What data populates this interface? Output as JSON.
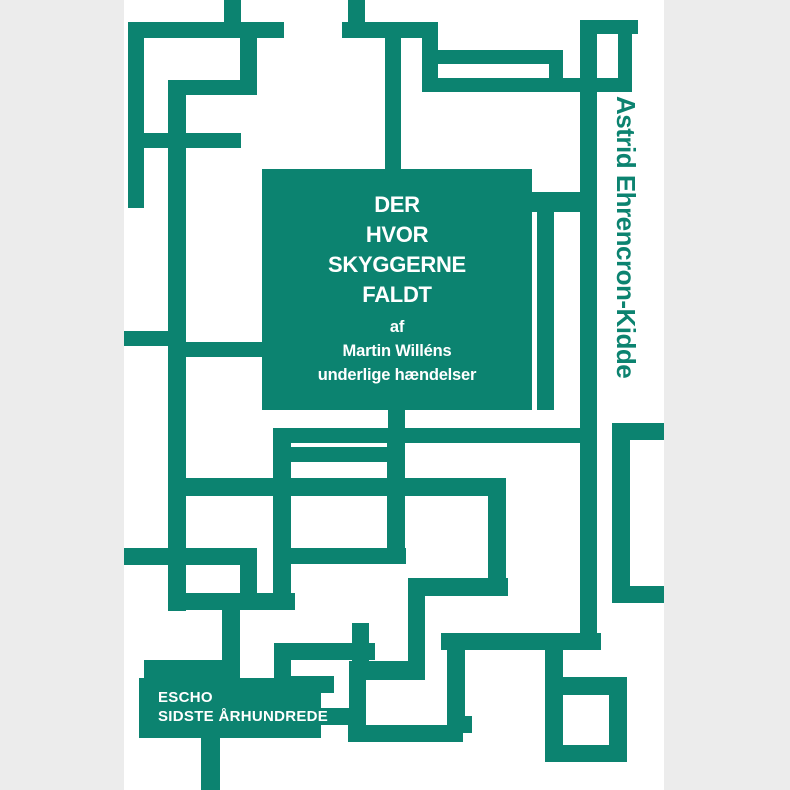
{
  "background": {
    "page_bg": "#ECECEC",
    "cover_bg": "#FFFFFF",
    "accent": "#0C8370",
    "text_on_accent": "#FFFFFF"
  },
  "cover": {
    "title_lines": [
      "DER",
      "HVOR",
      "SKYGGERNE",
      "FALDT"
    ],
    "subtitle_lines": [
      "af",
      "Martin Willéns",
      "underlige hændelser"
    ],
    "author": "Astrid Ehrencron-Kidde",
    "publisher_lines": [
      "ESCHO",
      "SIDSTE ÅRHUNDREDE"
    ]
  },
  "maze": {
    "segments": [
      [
        224,
        0,
        17,
        38
      ],
      [
        128,
        22,
        156,
        16
      ],
      [
        128,
        22,
        16,
        186
      ],
      [
        128,
        133,
        113,
        15
      ],
      [
        240,
        38,
        17,
        57
      ],
      [
        168,
        80,
        89,
        15
      ],
      [
        168,
        80,
        18,
        531
      ],
      [
        342,
        22,
        81,
        16
      ],
      [
        348,
        0,
        17,
        22
      ],
      [
        422,
        22,
        16,
        70
      ],
      [
        423,
        50,
        140,
        14
      ],
      [
        549,
        50,
        14,
        42
      ],
      [
        422,
        78,
        210,
        14
      ],
      [
        582,
        20,
        56,
        14
      ],
      [
        618,
        34,
        14,
        44
      ],
      [
        580,
        20,
        17,
        630
      ],
      [
        385,
        38,
        16,
        134
      ],
      [
        532,
        192,
        65,
        20
      ],
      [
        537,
        212,
        17,
        198
      ],
      [
        388,
        410,
        17,
        20
      ],
      [
        273,
        428,
        324,
        15
      ],
      [
        273,
        428,
        18,
        182
      ],
      [
        291,
        447,
        96,
        15
      ],
      [
        387,
        443,
        18,
        120
      ],
      [
        291,
        548,
        115,
        16
      ],
      [
        186,
        478,
        320,
        18
      ],
      [
        488,
        496,
        18,
        96
      ],
      [
        408,
        578,
        100,
        18
      ],
      [
        408,
        578,
        17,
        102
      ],
      [
        124,
        331,
        62,
        15
      ],
      [
        168,
        342,
        94,
        15
      ],
      [
        124,
        548,
        116,
        17
      ],
      [
        240,
        548,
        17,
        62
      ],
      [
        168,
        593,
        127,
        17
      ],
      [
        222,
        610,
        18,
        55
      ],
      [
        144,
        660,
        96,
        18
      ],
      [
        201,
        738,
        19,
        52
      ],
      [
        274,
        643,
        101,
        17
      ],
      [
        274,
        643,
        17,
        50
      ],
      [
        274,
        676,
        60,
        17
      ],
      [
        352,
        623,
        17,
        42
      ],
      [
        349,
        661,
        17,
        81
      ],
      [
        366,
        661,
        57,
        19
      ],
      [
        321,
        708,
        28,
        17
      ],
      [
        348,
        725,
        115,
        17
      ],
      [
        447,
        650,
        18,
        83
      ],
      [
        447,
        716,
        25,
        17
      ],
      [
        441,
        633,
        160,
        17
      ],
      [
        545,
        650,
        18,
        112
      ],
      [
        545,
        745,
        82,
        17
      ],
      [
        609,
        677,
        18,
        85
      ],
      [
        545,
        677,
        82,
        18
      ],
      [
        612,
        423,
        52,
        17
      ],
      [
        612,
        423,
        18,
        180
      ],
      [
        612,
        586,
        52,
        17
      ]
    ]
  }
}
